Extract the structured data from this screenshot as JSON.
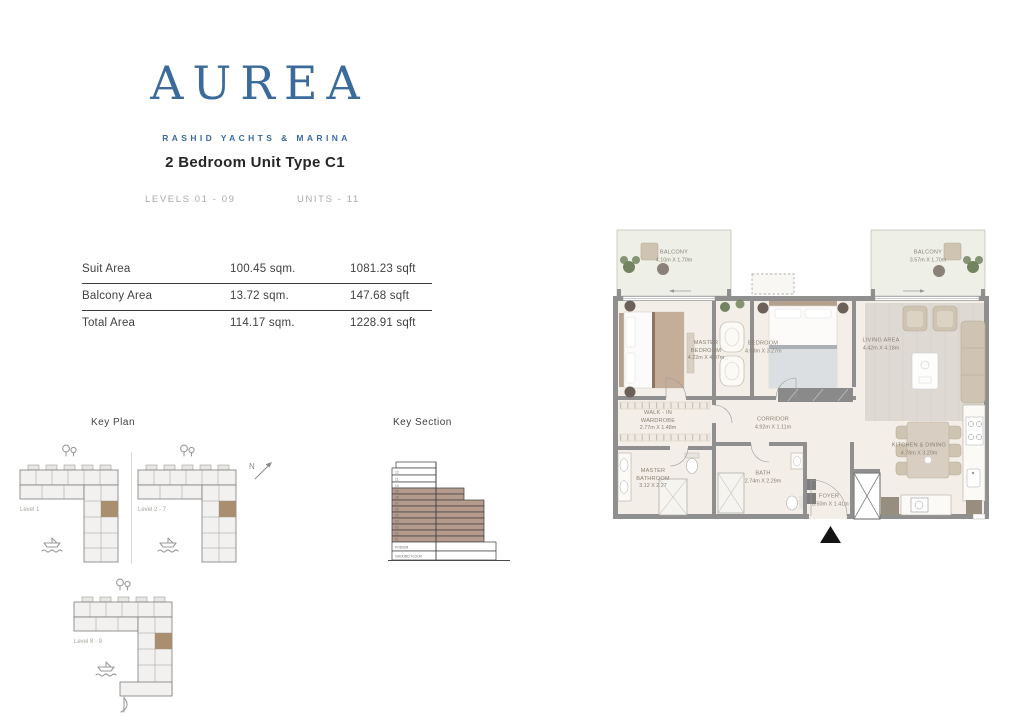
{
  "header": {
    "brand": "AUREA",
    "tagline": "RASHID YACHTS & MARINA",
    "unit_title": "2 Bedroom Unit Type C1",
    "levels_label": "LEVELS 01 - 09",
    "units_label": "UNITS - 11"
  },
  "area_table": {
    "rows": [
      {
        "label": "Suit Area",
        "sqm": "100.45 sqm.",
        "sqft": "1081.23 sqft"
      },
      {
        "label": "Balcony Area",
        "sqm": "13.72 sqm.",
        "sqft": "147.68 sqft"
      },
      {
        "label": "Total Area",
        "sqm": "114.17 sqm.",
        "sqft": "1228.91 sqft"
      }
    ]
  },
  "key_plan": {
    "title": "Key Plan",
    "north_label": "N",
    "plans": [
      {
        "level": "Level 1"
      },
      {
        "level": "Level 2 - 7"
      },
      {
        "level": "Level 8 - 9"
      }
    ]
  },
  "key_section": {
    "title": "Key Section",
    "upper_floors": [
      "12",
      "11",
      "10"
    ],
    "highlight_floors": [
      "09",
      "08",
      "07",
      "06",
      "05",
      "04",
      "03",
      "02",
      "01"
    ],
    "podium_label": "PODIUM",
    "ground_label": "GROUND FLOOR"
  },
  "floor_plan": {
    "rooms": {
      "balcony_left": {
        "name": "BALCONY",
        "dims": "4.10m X 1.70m"
      },
      "balcony_right": {
        "name": "BALCONY",
        "dims": "3.57m X 1.70m"
      },
      "master_bedroom": {
        "name": "MASTER BEDROOM",
        "dims": "4.22m X 4.07m"
      },
      "bedroom": {
        "name": "BEDROOM",
        "dims": "4.03m X 3.27m"
      },
      "living_area": {
        "name": "LIVING AREA",
        "dims": "4.42m X 4.18m"
      },
      "walk_in_wardrobe": {
        "name": "WALK - IN WARDROBE",
        "dims": "2.77m X 1.48m"
      },
      "corridor": {
        "name": "CORRIDOR",
        "dims": "4.92m X 1.11m"
      },
      "kitchen_dining": {
        "name": "KITCHEN & DINING",
        "dims": "4.78m X 3.20m"
      },
      "master_bathroom": {
        "name": "MASTER BATHROOM",
        "dims": "3.12 X 2.27"
      },
      "bath": {
        "name": "BATH",
        "dims": "2.74m X 2.29m"
      },
      "foyer": {
        "name": "FOYER",
        "dims": "3.50m X 1.41m"
      }
    }
  },
  "colors": {
    "brand_blue": "#3b6b9b",
    "section_highlight": "#b59a8e",
    "keyplan_highlight": "#a98f70"
  }
}
